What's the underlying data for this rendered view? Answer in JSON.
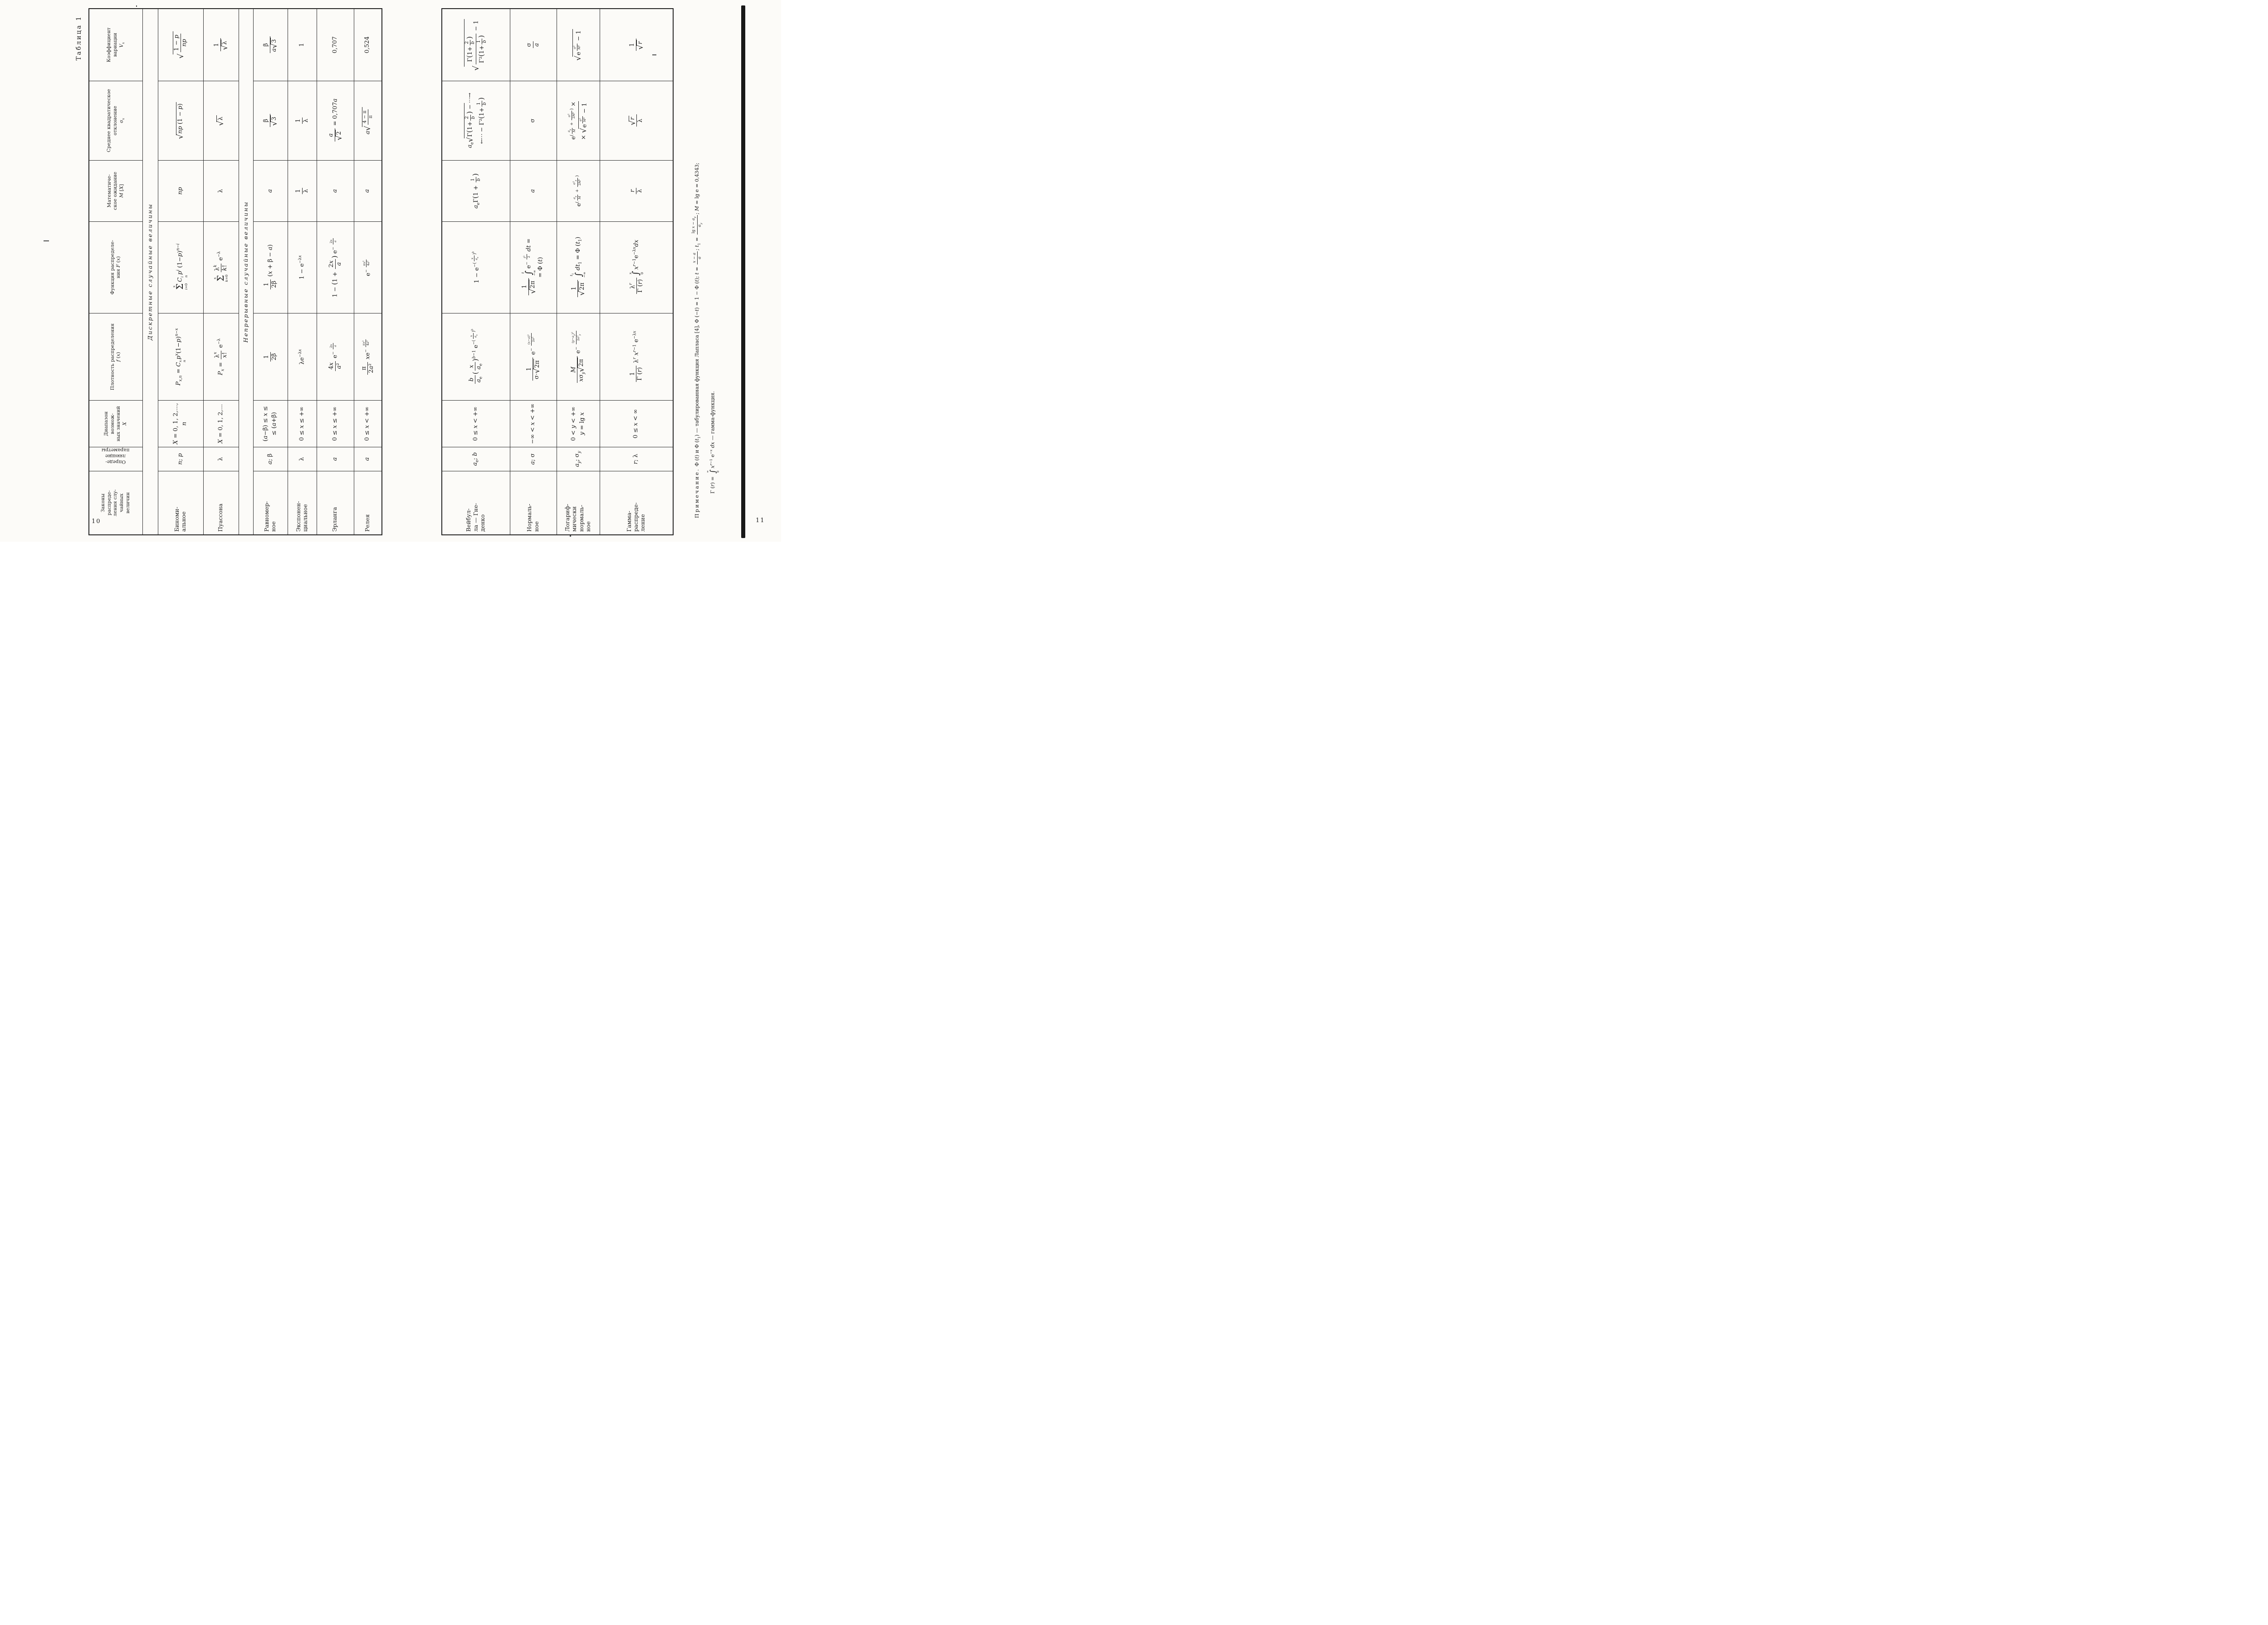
{
  "caption": "Таблица 1",
  "page_numbers": {
    "left": "10",
    "right": "11"
  },
  "sections": {
    "discrete": "Дискретные случайные величины",
    "continuous": "Непрерывные случайные величины"
  },
  "columns": {
    "laws": "Законы<br>распреде-<br>ления слу-<br>чайных<br>величин",
    "params": "Опреде-<br>ляющие<br>параметры",
    "range": "Диапазон возмож-<br>ных значений<br><i>X</i>",
    "density": "Плотность распределения<br><i>f</i> (<i>x</i>)",
    "cdf": "Функция распределе-<br>ния <i>F</i> (<i>x</i>)",
    "mean": "Математиче-<br>ское ожидание<br><i>M</i> [<i>X</i>]",
    "std": "Среднее квадратическое<br>отклонение<br>σ<sub><i>x</i></sub>",
    "varcoef": "Коэффициент<br>вариации<br><i>V<sub>x</sub></i>"
  },
  "rows": [
    {
      "name": "Биноми-<br>альное",
      "params": "<i>n</i>; <i>p</i>",
      "range": "<i>X</i> = 0, 1, 2,…, <i>n</i>",
      "density": "<i>P<sub>x,n</sub></i> = <i>C</i><span class='ss'><span><i>x</i></span><span><i>n</i></span></span><i>p</i><sup><i>x</i></sup>(1−<i>p</i>)<sup><i>n</i>−<i>x</i></sup>",
      "cdf": "<span class='st'><span><i>x</i></span><span class='g'>Σ</span><span><i>i</i>=0</span></span><i>C</i><span class='ss'><span><i>i</i></span><span><i>n</i></span></span><i>p</i><sup><i>i</i></sup> (1−<i>p</i>)<sup><i>n</i>−<i>i</i></sup>",
      "mean": "<i>np</i>",
      "std": "<span class='sq'><span class='r'>√</span><span class='o'><i>np</i> (1 − <i>p</i>)</span></span>",
      "varcoef": "<span class='sq'><span class='r'>√</span><span class='o'><span class='fr'><span class='nu'>1 − <i>p</i></span><span class='de'><i>np</i></span></span></span></span>"
    },
    {
      "name": "Пуассона",
      "params": "λ",
      "range": "<i>X</i> = 0, 1, 2,…",
      "density": "<i>P<sub>x</sub></i> = <span class='fr'><span class='nu'>λ<sup><i>x</i></sup></span><span class='de'><i>x</i>!</span></span> e<sup>−λ</sup>",
      "cdf": "<span class='st'><span><i>x</i></span><span class='g'>Σ</span><span><i>k</i>=0</span></span><span class='fr'><span class='nu'>λ<sup><i>k</i></sup></span><span class='de'><i>k</i>!</span></span> e<sup>−λ</sup>",
      "mean": "λ",
      "std": "<span class='sq'><span class='r'>√</span><span class='o'>λ</span></span>",
      "varcoef": "<span class='fr'><span class='nu'>1</span><span class='de'><span class='sq'><span class='r'>√</span><span class='o'>λ</span></span></span></span>"
    },
    {
      "name": "Равномер-<br>ное",
      "params": "<i>a</i>; β",
      "range": "(<i>a</i>−β) ≤ <i>x</i> ≤<br>≤ (<i>a</i>+β)",
      "density": "<span class='fr'><span class='nu'>1</span><span class='de'>2β</span></span>",
      "cdf": "<span class='fr'><span class='nu'>1</span><span class='de'>2β</span></span> (<i>x</i> + β − <i>a</i>)",
      "mean": "<i>a</i>",
      "std": "<span class='fr'><span class='nu'>β</span><span class='de'><span class='sq'><span class='r'>√</span><span class='o'>3</span></span></span></span>",
      "varcoef": "<span class='fr'><span class='nu'>β</span><span class='de'><i>a</i><span class='sq'><span class='r'>√</span><span class='o'>3</span></span></span></span>"
    },
    {
      "name": "Экспонен-<br>циальное",
      "params": "λ",
      "range": "0 ≤ <i>x</i> ≤ +∞",
      "density": "λe<sup>−λ<i>x</i></sup>",
      "cdf": "1 − e<sup>−λ<i>x</i></sup>",
      "mean": "<span class='fr'><span class='nu'>1</span><span class='de'>λ</span></span>",
      "std": "<span class='fr'><span class='nu'>1</span><span class='de'>λ</span></span>",
      "varcoef": "1"
    },
    {
      "name": "Эрланга",
      "params": "<i>a</i>",
      "range": "0 ≤ <i>x</i> ≤ +∞",
      "density": "<span class='fr'><span class='nu'>4<i>x</i></span><span class='de'><i>a</i>²</span></span> e<sup>− <span class='fr s'><span class='nu'>2<i>x</i></span><span class='de'><i>a</i></span></span></sup>",
      "cdf": "1 − <span class='p'>(</span>1 + <span class='fr'><span class='nu'>2<i>x</i></span><span class='de'><i>a</i></span></span><span class='p'>)</span> e<sup>− <span class='fr s'><span class='nu'>2<i>x</i></span><span class='de'><i>a</i></span></span></sup>",
      "mean": "<i>a</i>",
      "std": "<span class='fr'><span class='nu'><i>a</i></span><span class='de'><span class='sq'><span class='r'>√</span><span class='o'>2</span></span></span></span> = 0,707<i>a</i>",
      "varcoef": "0,707"
    },
    {
      "name": "Релея",
      "params": "<i>a</i>",
      "range": "0 ≤ <i>x</i> < +∞",
      "density": "<span class='fr'><span class='nu'>π</span><span class='de'>2<i>a</i>²</span></span> <i>x</i>e<sup>− <span class='fr s'><span class='nu'>π<i>x</i>²</span><span class='de'>4<i>a</i>²</span></span></sup>",
      "cdf": "e<sup>− <span class='fr s'><span class='nu'>π<i>x</i>²</span><span class='de'>4<i>a</i>²</span></span></sup>",
      "mean": "<i>a</i>",
      "std": "<i>a</i><span class='sq'><span class='r'>√</span><span class='o'><span class='fr s'><span class='nu'>4 − π</span><span class='de'>π</span></span></span></span>",
      "varcoef": "0,524"
    },
    {
      "name": "Вейбул-<br>ла — Гне-<br>денко",
      "params": "<i>a</i><sub>е</sub>; <i>b</i>",
      "range": "0 ≤ <i>x</i> < +∞",
      "density": "<span class='fr'><span class='nu'><i>b</i></span><span class='de'><i>a</i><sub>е</sub></span></span><span class='p'>(</span><span class='fr'><span class='nu'><i>x</i></span><span class='de'><i>a</i><sub>е</sub></span></span><span class='p'>)</span><sup><i>b</i>−1</sup> e<sup>−(<span class='fr s'><span class='nu'><i>x</i></span><span class='de'><i>a</i><sub>е</sub></span></span>)<sup><i>b</i></sup></sup>",
      "cdf": "1 − e<sup>−(<span class='fr s'><span class='nu'><i>x</i></span><span class='de'><i>a</i><sub>е</sub></span></span>)<sup><i>b</i></sup></sup>",
      "mean": "<i>a</i><sub>е</sub>Γ<span class='p'>(</span>1 + <span class='fr s'><span class='nu'>1</span><span class='de'><i>b</i></span></span><span class='p'>)</span>",
      "std": "<i>a</i><sub>е</sub><span class='sq'><span class='r'>√</span><span class='o'>Γ<span class='p'>(</span>1+<span class='fr s'><span class='nu'>2</span><span class='de'><i>b</i></span></span><span class='p'>)</span> −</span></span><span class='dots'>⋯→</span><br><span class='dots'>←⋯</span> − Γ²<span class='p'>(</span>1+<span class='fr s'><span class='nu'>1</span><span class='de'><i>b</i></span></span><span class='p'>)</span>",
      "varcoef": "<span class='sq'><span class='r'>√</span><span class='o'><span class='fr'><span class='nu'>Γ<span class='p'>(</span>1+<span class='fr s'><span class='nu'>2</span><span class='de'><i>b</i></span></span><span class='p'>)</span></span><span class='de'>Γ²<span class='p'>(</span>1+<span class='fr s'><span class='nu'>1</span><span class='de'><i>b</i></span></span><span class='p'>)</span></span></span> − 1</span></span>"
    },
    {
      "name": "Нормаль-<br>ное",
      "params": "<i>a</i>; σ",
      "range": "−∞ < <i>x</i> < +∞",
      "density": "<span class='fr'><span class='nu'>1</span><span class='de'>σ·<span class='sq'><span class='r'>√</span><span class='o'>2π</span></span></span></span> e<sup>− <span class='fr s'><span class='nu'>(<i>x</i>−<i>a</i>)²</span><span class='de'>2σ²</span></span></sup>",
      "cdf": "<span class='fr'><span class='nu'>1</span><span class='de'><span class='sq'><span class='r'>√</span><span class='o'>2π</span></span></span></span><span class='st'><span><i>t</i></span><span class='g'>∫</span><span>−∞</span></span>e<sup>− <span class='fr s'><span class='nu'><i>t</i>²</span><span class='de'>2</span></span></sup> <i>dt</i> =<br>= Φ (<i>t</i>)",
      "mean": "<i>a</i>",
      "std": "σ",
      "varcoef": "<span class='fr'><span class='nu'>σ</span><span class='de'><i>a</i></span></span>"
    },
    {
      "name": "Логариф-<br>мически<br>нормаль-<br>ное",
      "params": "<i>a<sub>y</sub></i>; σ<sub><i>y</i></sub>",
      "range": "0 < <i>y</i> < +∞<br><i>y</i> = lg <i>x</i>",
      "density": "<span class='fr'><span class='nu'><i>M</i></span><span class='de'><i>x</i>σ<sub><i>y</i></sub><span class='sq'><span class='r'>√</span><span class='o'>2π</span></span></span></span> e<sup>− <span class='fr s'><span class='nu'>(<i>y</i>−<i>a<sub>y</sub></i>)²</span><span class='de'>2σ²<sub><i>y</i></sub></span></span></sup>",
      "cdf": "<span class='fr'><span class='nu'>1</span><span class='de'><span class='sq'><span class='r'>√</span><span class='o'>2π</span></span></span></span><span class='st'><span><i>t</i><sub>1</sub></span><span class='g'>∫</span><span>−∞</span></span><i>dt</i><sub>1</sub> = Φ (<i>t</i><sub>1</sub>)",
      "mean": "e<sup>(<span class='fr s'><span class='nu'><i>a<sub>y</sub></i></span><span class='de'><i>M</i></span></span> + <span class='fr s'><span class='nu'>σ²<sub><i>y</i></sub></span><span class='de'>2<i>M</i>²</span></span>)</sup>",
      "std": "e<sup>(<span class='fr s'><span class='nu'><i>a<sub>y</sub></i></span><span class='de'><i>M</i></span></span> + <span class='fr s'><span class='nu'>σ²</span><span class='de'>2<i>M</i>²</span></span>)</sup> ×<br>× <span class='sq'><span class='r'>√</span><span class='o'>e<sup><span class='fr s'><span class='nu'>σ²</span><span class='de'><i>M</i>²</span></span></sup> − 1</span></span>",
      "varcoef": "<span class='sq'><span class='r'>√</span><span class='o'>e<sup><span class='fr s'><span class='nu'>σ²</span><span class='de'><i>M</i>²</span></span></sup> − 1</span></span>"
    },
    {
      "name": "Гамма-<br>распреде-<br>ление",
      "params": "<i>r</i>; λ",
      "range": "0 ≤ <i>x</i> < ∞",
      "density": "<span class='fr'><span class='nu'>1</span><span class='de'>Γ (<i>r</i>)</span></span> λ<sup><i>r</i></sup> <i>x</i><sup><i>r</i>−1</sup> e<sup>−λ<i>x</i></sup>",
      "cdf": "<span class='fr'><span class='nu'>λ<sup><i>r</i></sup></span><span class='de'>Γ (<i>r</i>)</span></span><span class='st'><span><i>x</i></span><span class='g'>∫</span><span>0</span></span><i>x</i><sup><i>r</i>−1</sup>e<sup>−λ<i>x</i></sup><i>dx</i>",
      "mean": "<span class='fr'><span class='nu'><i>r</i></span><span class='de'>λ</span></span>",
      "std": "<span class='fr'><span class='nu'><span class='sq'><span class='r'>√</span><span class='o'><i>r</i></span></span></span><span class='de'>λ</span></span>",
      "varcoef": "<span class='fr'><span class='nu'>1</span><span class='de'><span class='sq'><span class='r'>√</span><span class='o'><i>r</i></span></span></span></span>"
    }
  ],
  "footnote": {
    "line1": "<span class='ind'></span><span class='sp'>Примечание.</span> Φ (<i>t</i>) и Φ (<i>t</i><sub>1</sub>) — табулированная функция Лапласа [4], Φ (−<i>t</i>) = 1 − Φ (<i>t</i>); <i>t</i> = <span class='fr s'><span class='nu'><i>x</i> − <i>a</i></span><span class='de'>σ</span></span>; <i>t</i><sub>1</sub> = <span class='fr s'><span class='nu'>lg <i>x</i> − <i>a<sub>y</sub></i></span><span class='de'>σ<sub><i>y</i></sub></span></span>; <i>M</i> = lg e = 0,4343;",
    "line2": "Γ (<i>r</i>) = <span class='st'><span>∞</span><span class='g'>∫</span><span>0</span></span><i>x</i><sup><i>r</i>−1</sup> e<sup>−<i>x</i></sup> <i>dx</i> — гамма-функция."
  }
}
